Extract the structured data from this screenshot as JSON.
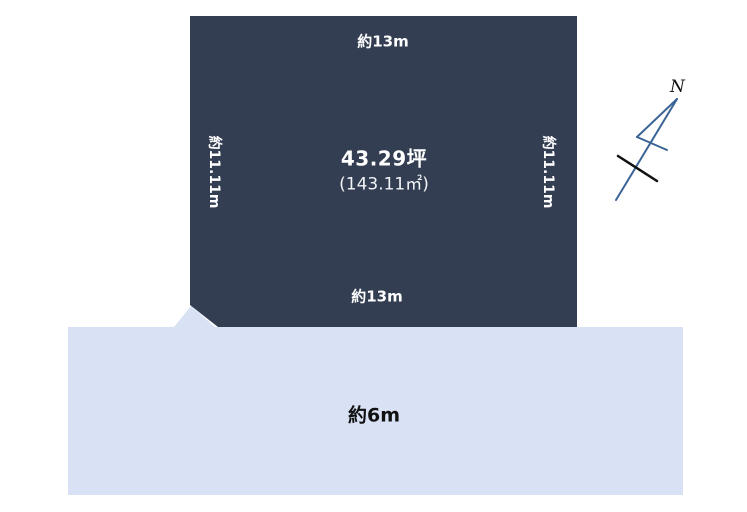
{
  "diagram": {
    "plot": {
      "area_tsubo": "43.29坪",
      "area_sqm": "(143.11㎡)",
      "top_dim": "約13m",
      "bottom_dim": "約13m",
      "left_dim": "約11.11m",
      "right_dim": "約11.11m",
      "fill_color": "#333e52",
      "text_color": "#ffffff"
    },
    "road": {
      "width_label": "約6m",
      "fill_color": "#d9e2f4",
      "text_color": "#111111"
    },
    "compass": {
      "north_label": "N",
      "needle_color": "#3b6496",
      "tick_color": "#111111"
    }
  }
}
